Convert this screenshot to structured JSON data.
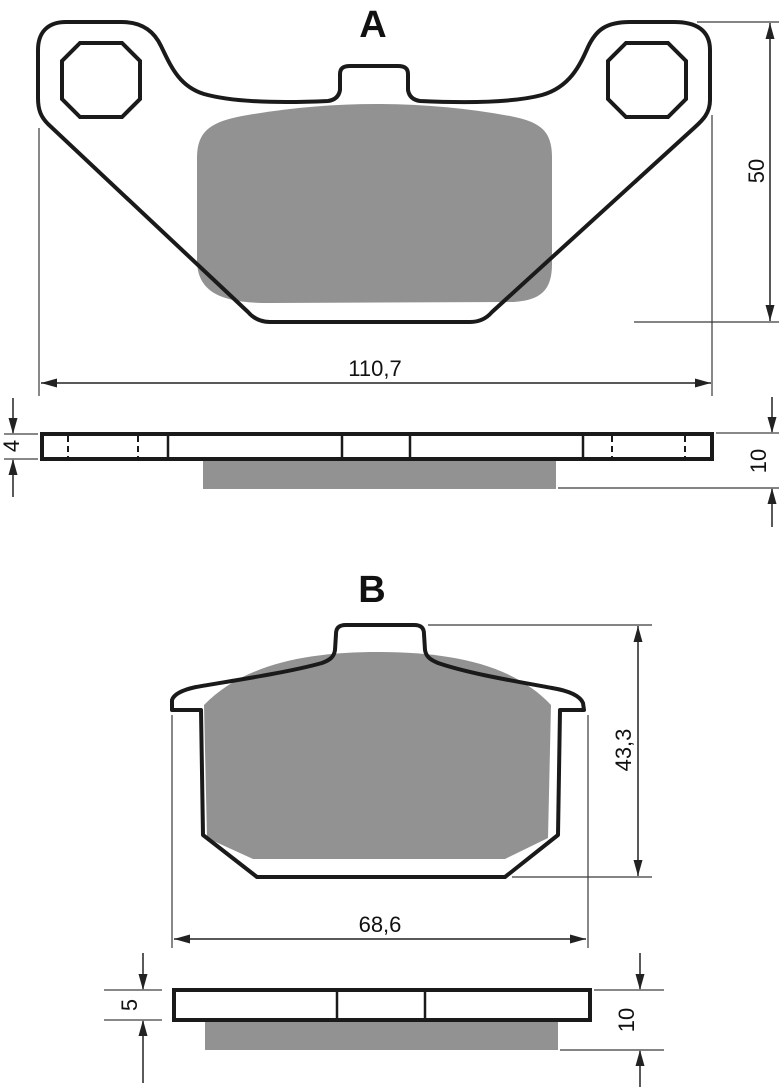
{
  "drawing": {
    "type": "brake-pad-technical-drawing",
    "colors": {
      "background": "#ffffff",
      "outline": "#1a1a1a",
      "friction": "#929292",
      "dimension": "#222222",
      "extension": "#777777"
    },
    "pad_a": {
      "label": "A",
      "width": "110,7",
      "height": "50",
      "backplate_thickness": "4",
      "total_thickness": "10"
    },
    "pad_b": {
      "label": "B",
      "width": "68,6",
      "height": "43,3",
      "backplate_thickness": "5",
      "total_thickness": "10"
    }
  }
}
